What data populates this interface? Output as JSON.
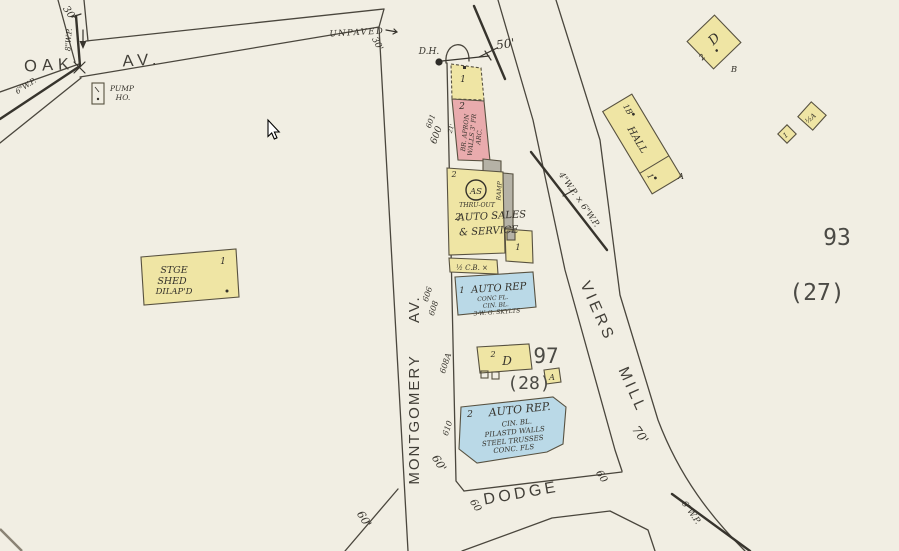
{
  "map": {
    "streets": {
      "oak": "OAK AV.",
      "montgomery": "MONTGOMERY AV.",
      "viers": "VIERS MILL",
      "dodge": "DODGE",
      "unpaved": "UNPAVED"
    },
    "blocks": {
      "n93": "93",
      "n27": "(27)",
      "n97": "97",
      "n28": "(28)"
    },
    "widths": {
      "w30_top": "30'",
      "w30_unpaved": "30'",
      "w50": "50'",
      "w60_mont": "60'",
      "w60_dodge_w": "60",
      "w60_dodge_e": "60",
      "w60_sw": "60'",
      "w70": "70'"
    },
    "pipes": {
      "wp8": "8\"W.P.",
      "wp6_left": "6\"W.P.",
      "wp46": "4\"W.P. × 6\"W.P.",
      "wp6_bottom": "6\"W.P."
    },
    "features": {
      "dh": "D.H.",
      "pump_line1": "PUMP",
      "pump_line2": "HO."
    },
    "addresses": {
      "a601": "601",
      "a600": "600",
      "a606": "606",
      "a608": "608",
      "a608a": "608A",
      "a610": "610",
      "d21": "21'"
    },
    "buildings": {
      "office_shed": {
        "story": "1"
      },
      "paint": {
        "story": "2",
        "note1": "BR. APRON",
        "note2": "WALLS 3' FR",
        "note3": "ARC."
      },
      "auto_sales": {
        "symbol": "AS",
        "thru": "THRU-OUT",
        "ramp": "RAMP",
        "story_top": "2",
        "story_main": "2",
        "name1": "AUTO SALES",
        "name2": "& SERVICE",
        "wing_story": "1"
      },
      "cb_shed": {
        "label": "½ C.B. ×"
      },
      "auto_rep1": {
        "story": "1",
        "name": "AUTO REP",
        "note1": "CONC FL.",
        "note2": "CIN. BL.",
        "note3": "3-W. G. SKYLTS"
      },
      "dwelling": {
        "story": "2",
        "cls": "D"
      },
      "shed_a": {
        "cls": "A"
      },
      "auto_rep2": {
        "story": "2",
        "name": "AUTO REP.",
        "note1": "CIN. BL.",
        "note2": "PILASTD WALLS",
        "note3": "STEEL TRUSSES",
        "note4": "CONC. FLS"
      },
      "stge_shed": {
        "line1": "STGE",
        "line2": "SHED",
        "line3": "DILAP'D",
        "story": "1"
      },
      "hall": {
        "corner": "1B",
        "name": "HALL",
        "story": "1",
        "ext": "A"
      },
      "d_bldg": {
        "cls": "D",
        "story": "2",
        "ext": "B"
      },
      "diamond_small": {
        "story": "1"
      },
      "diamond_large": {
        "label": "½A"
      }
    }
  }
}
